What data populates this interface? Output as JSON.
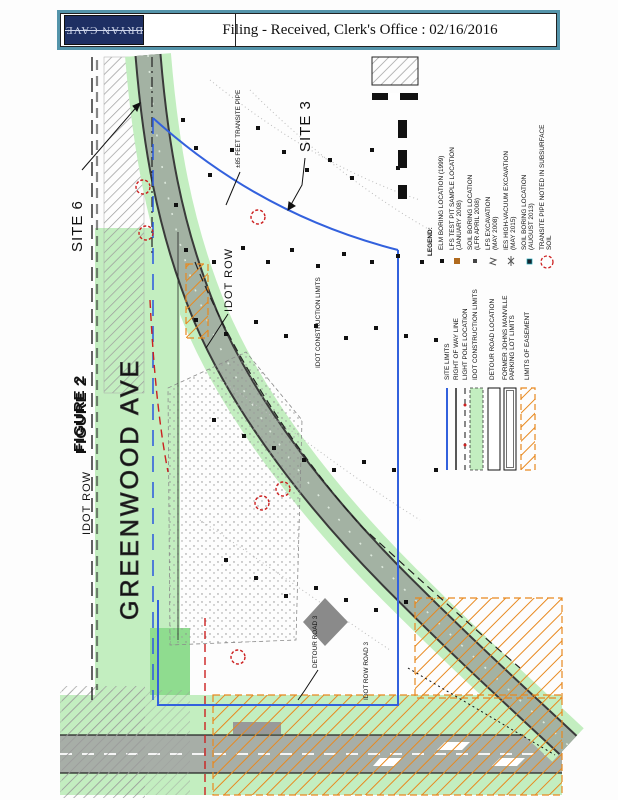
{
  "header": {
    "logo_text": "BRYAN CAVE",
    "stamp_text": "Filing - Received,  Clerk's  Office  :  02/16/2016"
  },
  "figure": {
    "labels": {
      "site6": "SITE 6",
      "site3": "SITE 3",
      "figure_no": "FIGURE 2",
      "greenwood": "GREENWOOD AVE",
      "idot_row_left": "IDOT ROW",
      "idot_row_mid": "IDOT ROW",
      "transite_note": "±85 FEET TRANSITE PIPE",
      "construction_limits": "IDOT CONSTRUCTION LIMITS",
      "detour_road": "DETOUR ROAD 3",
      "idot_row_road": "IDOT ROW ROAD 3"
    },
    "legend": {
      "title": "LEGEND:",
      "symbols": [
        {
          "label": "ELM BORING LOCATION (1999)",
          "label2": ""
        },
        {
          "label": "LFS TEST PIT SAMPLE LOCATION",
          "label2": "(JANUARY 2008)"
        },
        {
          "label": "SOIL BORING LOCATION",
          "label2": "(LFR APRIL 2008)"
        },
        {
          "label": "LFS EXCAVATION",
          "label2": "(MAY 2008)"
        },
        {
          "label": "IES HIGH-VACUUM EXCAVATION",
          "label2": "(MAY 2015)"
        },
        {
          "label": "SOIL BORING LOCATION",
          "label2": "(AUGUST 2013)"
        },
        {
          "label": "TRANSITE PIPE NOTED IN SUBSURFACE",
          "label2": "SOIL"
        }
      ],
      "areas": [
        {
          "label": "SITE LIMITS",
          "label2": ""
        },
        {
          "label": "RIGHT OF WAY LINE",
          "label2": ""
        },
        {
          "label": "LIGHT POLE LOCATION",
          "label2": ""
        },
        {
          "label": "IDOT CONSTRUCTION LIMITS",
          "label2": ""
        },
        {
          "label": "DETOUR ROAD LOCATION",
          "label2": ""
        },
        {
          "label": "FORMER JOHNS MANVILLE",
          "label2": "PARKING LOT LIMITS"
        },
        {
          "label": "LIMITS OF EASEMENT",
          "label2": ""
        }
      ]
    },
    "colors": {
      "teal_border": "#5494aa",
      "navy_logo": "#1e2f63",
      "light_green": "#c3eec0",
      "bright_green": "#8fdc8f",
      "road_sage": "#a3b2a3",
      "road_gray": "#a7aea7",
      "orange": "#e8891f",
      "site_blue": "#3361dd",
      "red": "#cc2020",
      "hatch_gray": "#9a9a9a"
    },
    "markers": {
      "borings": [
        [
          183,
          120
        ],
        [
          196,
          148
        ],
        [
          210,
          175
        ],
        [
          176,
          205
        ],
        [
          232,
          150
        ],
        [
          258,
          128
        ],
        [
          284,
          152
        ],
        [
          307,
          170
        ],
        [
          330,
          160
        ],
        [
          352,
          178
        ],
        [
          372,
          150
        ],
        [
          398,
          168
        ],
        [
          186,
          250
        ],
        [
          214,
          262
        ],
        [
          243,
          248
        ],
        [
          268,
          262
        ],
        [
          292,
          250
        ],
        [
          318,
          266
        ],
        [
          344,
          254
        ],
        [
          372,
          262
        ],
        [
          398,
          256
        ],
        [
          422,
          262
        ],
        [
          196,
          320
        ],
        [
          226,
          334
        ],
        [
          256,
          322
        ],
        [
          286,
          336
        ],
        [
          316,
          326
        ],
        [
          346,
          338
        ],
        [
          376,
          328
        ],
        [
          406,
          336
        ],
        [
          214,
          420
        ],
        [
          244,
          436
        ],
        [
          274,
          448
        ],
        [
          304,
          460
        ],
        [
          334,
          470
        ],
        [
          364,
          462
        ],
        [
          394,
          470
        ],
        [
          226,
          560
        ],
        [
          256,
          578
        ],
        [
          286,
          596
        ],
        [
          316,
          588
        ],
        [
          346,
          600
        ],
        [
          376,
          610
        ],
        [
          406,
          602
        ],
        [
          436,
          470
        ],
        [
          436,
          340
        ]
      ],
      "transite_circles": [
        [
          143,
          187
        ],
        [
          146,
          233
        ],
        [
          258,
          217
        ],
        [
          262,
          503
        ],
        [
          283,
          489
        ],
        [
          238,
          657
        ]
      ]
    }
  }
}
